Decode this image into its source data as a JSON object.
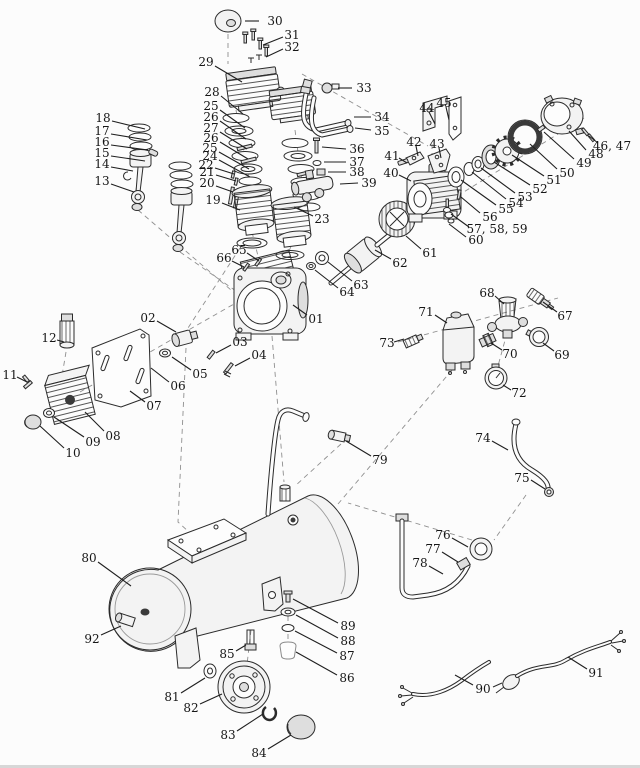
{
  "meta": {
    "description": "Exploded parts diagram of a portable air compressor, black line art on white",
    "bg": "#fcfcfc",
    "ink": "#2b2b2b",
    "label_color": "#161616",
    "dash_color": "#8f8f8f",
    "edge_strip": "#d7d7d7"
  },
  "diagram": {
    "parts": [
      {
        "n": "30",
        "x": 275,
        "y": 21,
        "l": [
          259,
          21,
          245,
          21
        ]
      },
      {
        "n": "31",
        "x": 292,
        "y": 35,
        "l": [
          283,
          37,
          263,
          45
        ]
      },
      {
        "n": "32",
        "x": 292,
        "y": 47,
        "l": [
          283,
          49,
          266,
          57
        ]
      },
      {
        "n": "29",
        "x": 206,
        "y": 62,
        "l": [
          215,
          66,
          242,
          82
        ]
      },
      {
        "n": "33",
        "x": 364,
        "y": 88,
        "l": [
          352,
          88,
          338,
          88
        ]
      },
      {
        "n": "34",
        "x": 382,
        "y": 117,
        "l": [
          371,
          117,
          354,
          117
        ]
      },
      {
        "n": "35",
        "x": 382,
        "y": 131,
        "l": [
          371,
          130,
          355,
          128
        ]
      },
      {
        "n": "18",
        "x": 103,
        "y": 118,
        "l": [
          112,
          121,
          145,
          129
        ]
      },
      {
        "n": "17",
        "x": 102,
        "y": 131,
        "l": [
          111,
          134,
          147,
          140
        ]
      },
      {
        "n": "16",
        "x": 102,
        "y": 142,
        "l": [
          111,
          145,
          148,
          150
        ]
      },
      {
        "n": "15",
        "x": 102,
        "y": 153,
        "l": [
          111,
          156,
          145,
          161
        ]
      },
      {
        "n": "14",
        "x": 102,
        "y": 164,
        "l": [
          111,
          167,
          133,
          171
        ]
      },
      {
        "n": "13",
        "x": 102,
        "y": 181,
        "l": [
          111,
          184,
          134,
          192
        ]
      },
      {
        "n": "28",
        "x": 212,
        "y": 92,
        "l": [
          221,
          96,
          243,
          114
        ]
      },
      {
        "n": "25",
        "x": 211,
        "y": 106,
        "l": [
          220,
          110,
          245,
          128
        ]
      },
      {
        "n": "26",
        "x": 211,
        "y": 117,
        "l": [
          220,
          121,
          246,
          139
        ]
      },
      {
        "n": "27",
        "x": 211,
        "y": 128,
        "l": [
          220,
          132,
          247,
          149
        ]
      },
      {
        "n": "26",
        "x": 211,
        "y": 138,
        "l": [
          220,
          142,
          248,
          159
        ]
      },
      {
        "n": "25",
        "x": 210,
        "y": 148,
        "l": [
          219,
          152,
          249,
          169
        ]
      },
      {
        "n": "24",
        "x": 210,
        "y": 156,
        "l": [
          219,
          160,
          250,
          177
        ]
      },
      {
        "n": "22",
        "x": 206,
        "y": 165,
        "l": [
          215,
          168,
          234,
          174
        ]
      },
      {
        "n": "21",
        "x": 207,
        "y": 172,
        "l": [
          216,
          175,
          236,
          181
        ]
      },
      {
        "n": "20",
        "x": 207,
        "y": 183,
        "l": [
          216,
          186,
          233,
          192
        ]
      },
      {
        "n": "19",
        "x": 213,
        "y": 200,
        "l": [
          222,
          203,
          240,
          210
        ]
      },
      {
        "n": "23",
        "x": 322,
        "y": 219,
        "l": [
          313,
          216,
          294,
          207
        ]
      },
      {
        "n": "44",
        "x": 427,
        "y": 108,
        "l": [
          429,
          112,
          435,
          124
        ]
      },
      {
        "n": "45",
        "x": 444,
        "y": 103,
        "l": [
          446,
          107,
          449,
          120
        ]
      },
      {
        "n": "42",
        "x": 414,
        "y": 142,
        "l": [
          416,
          146,
          418,
          156
        ]
      },
      {
        "n": "43",
        "x": 437,
        "y": 144,
        "l": [
          439,
          148,
          441,
          158
        ]
      },
      {
        "n": "41",
        "x": 392,
        "y": 156,
        "l": [
          399,
          158,
          407,
          163
        ]
      },
      {
        "n": "40",
        "x": 391,
        "y": 173,
        "l": [
          399,
          175,
          411,
          181
        ]
      },
      {
        "n": "46, 47",
        "x": 612,
        "y": 146,
        "l": [
          598,
          143,
          589,
          136
        ]
      },
      {
        "n": "48",
        "x": 596,
        "y": 154,
        "l": [
          586,
          150,
          569,
          131
        ]
      },
      {
        "n": "49",
        "x": 584,
        "y": 163,
        "l": [
          574,
          159,
          544,
          132
        ]
      },
      {
        "n": "50",
        "x": 567,
        "y": 173,
        "l": [
          557,
          169,
          530,
          144
        ]
      },
      {
        "n": "51",
        "x": 554,
        "y": 180,
        "l": [
          544,
          176,
          512,
          155
        ]
      },
      {
        "n": "52",
        "x": 540,
        "y": 189,
        "l": [
          530,
          185,
          494,
          162
        ]
      },
      {
        "n": "53",
        "x": 525,
        "y": 197,
        "l": [
          515,
          193,
          481,
          168
        ]
      },
      {
        "n": "54",
        "x": 516,
        "y": 203,
        "l": [
          506,
          199,
          472,
          172
        ]
      },
      {
        "n": "55",
        "x": 506,
        "y": 209,
        "l": [
          496,
          205,
          461,
          180
        ]
      },
      {
        "n": "56",
        "x": 490,
        "y": 217,
        "l": [
          480,
          213,
          461,
          197
        ]
      },
      {
        "n": "57, 58, 59",
        "x": 497,
        "y": 229,
        "l": [
          469,
          227,
          451,
          214
        ]
      },
      {
        "n": "60",
        "x": 476,
        "y": 240,
        "l": [
          466,
          237,
          449,
          224
        ]
      },
      {
        "n": "36",
        "x": 357,
        "y": 149,
        "l": [
          346,
          149,
          322,
          147
        ]
      },
      {
        "n": "37",
        "x": 357,
        "y": 162,
        "l": [
          346,
          162,
          324,
          162
        ]
      },
      {
        "n": "38",
        "x": 357,
        "y": 172,
        "l": [
          346,
          172,
          328,
          172
        ]
      },
      {
        "n": "39",
        "x": 369,
        "y": 183,
        "l": [
          358,
          183,
          340,
          184
        ]
      },
      {
        "n": "65",
        "x": 239,
        "y": 250,
        "l": [
          247,
          253,
          259,
          261
        ]
      },
      {
        "n": "66",
        "x": 224,
        "y": 258,
        "l": [
          232,
          261,
          244,
          267
        ]
      },
      {
        "n": "63",
        "x": 361,
        "y": 285,
        "l": [
          352,
          281,
          328,
          262
        ]
      },
      {
        "n": "64",
        "x": 347,
        "y": 292,
        "l": [
          338,
          288,
          315,
          270
        ]
      },
      {
        "n": "01",
        "x": 316,
        "y": 319,
        "l": [
          307,
          315,
          293,
          305
        ]
      },
      {
        "n": "02",
        "x": 148,
        "y": 318,
        "l": [
          157,
          321,
          176,
          332
        ]
      },
      {
        "n": "03",
        "x": 240,
        "y": 342,
        "l": [
          231,
          345,
          216,
          353
        ]
      },
      {
        "n": "04",
        "x": 259,
        "y": 355,
        "l": [
          250,
          358,
          235,
          366
        ]
      },
      {
        "n": "05",
        "x": 200,
        "y": 374,
        "l": [
          191,
          370,
          172,
          357
        ]
      },
      {
        "n": "06",
        "x": 178,
        "y": 386,
        "l": [
          169,
          382,
          151,
          368
        ]
      },
      {
        "n": "07",
        "x": 154,
        "y": 406,
        "l": [
          145,
          402,
          130,
          391
        ]
      },
      {
        "n": "08",
        "x": 113,
        "y": 436,
        "l": [
          104,
          431,
          85,
          412
        ]
      },
      {
        "n": "09",
        "x": 93,
        "y": 442,
        "l": [
          84,
          437,
          54,
          417
        ]
      },
      {
        "n": "10",
        "x": 73,
        "y": 453,
        "l": [
          64,
          448,
          40,
          426
        ]
      },
      {
        "n": "11",
        "x": 10,
        "y": 375,
        "l": [
          17,
          377,
          27,
          382
        ]
      },
      {
        "n": "12",
        "x": 49,
        "y": 338,
        "l": [
          57,
          340,
          64,
          342
        ]
      },
      {
        "n": "68",
        "x": 487,
        "y": 293,
        "l": [
          495,
          296,
          504,
          304
        ]
      },
      {
        "n": "67",
        "x": 565,
        "y": 316,
        "l": [
          557,
          312,
          543,
          302
        ]
      },
      {
        "n": "71",
        "x": 426,
        "y": 312,
        "l": [
          435,
          315,
          447,
          323
        ]
      },
      {
        "n": "73",
        "x": 387,
        "y": 343,
        "l": [
          394,
          342,
          404,
          339
        ]
      },
      {
        "n": "70",
        "x": 510,
        "y": 354,
        "l": [
          502,
          350,
          491,
          343
        ]
      },
      {
        "n": "69",
        "x": 562,
        "y": 355,
        "l": [
          554,
          351,
          543,
          343
        ]
      },
      {
        "n": "72",
        "x": 519,
        "y": 393,
        "l": [
          511,
          390,
          503,
          385
        ]
      },
      {
        "n": "79",
        "x": 380,
        "y": 460,
        "l": [
          371,
          456,
          346,
          441
        ]
      },
      {
        "n": "74",
        "x": 483,
        "y": 438,
        "l": [
          492,
          441,
          508,
          450
        ]
      },
      {
        "n": "75",
        "x": 522,
        "y": 478,
        "l": [
          531,
          480,
          545,
          489
        ]
      },
      {
        "n": "76",
        "x": 443,
        "y": 535,
        "l": [
          452,
          538,
          468,
          547
        ]
      },
      {
        "n": "77",
        "x": 433,
        "y": 549,
        "l": [
          442,
          552,
          458,
          562
        ]
      },
      {
        "n": "78",
        "x": 420,
        "y": 563,
        "l": [
          429,
          566,
          443,
          574
        ]
      },
      {
        "n": "80",
        "x": 89,
        "y": 558,
        "l": [
          98,
          562,
          131,
          586
        ]
      },
      {
        "n": "92",
        "x": 92,
        "y": 639,
        "l": [
          101,
          635,
          121,
          626
        ]
      },
      {
        "n": "85",
        "x": 227,
        "y": 654,
        "l": [
          236,
          651,
          246,
          645
        ]
      },
      {
        "n": "81",
        "x": 172,
        "y": 697,
        "l": [
          181,
          693,
          205,
          678
        ]
      },
      {
        "n": "82",
        "x": 191,
        "y": 708,
        "l": [
          200,
          704,
          222,
          694
        ]
      },
      {
        "n": "83",
        "x": 228,
        "y": 735,
        "l": [
          237,
          731,
          263,
          714
        ]
      },
      {
        "n": "84",
        "x": 259,
        "y": 753,
        "l": [
          268,
          749,
          291,
          735
        ]
      },
      {
        "n": "89",
        "x": 348,
        "y": 626,
        "l": [
          338,
          623,
          293,
          599
        ]
      },
      {
        "n": "88",
        "x": 348,
        "y": 641,
        "l": [
          338,
          638,
          296,
          615
        ]
      },
      {
        "n": "87",
        "x": 347,
        "y": 656,
        "l": [
          337,
          653,
          295,
          631
        ]
      },
      {
        "n": "86",
        "x": 347,
        "y": 678,
        "l": [
          337,
          675,
          296,
          652
        ]
      },
      {
        "n": "90",
        "x": 483,
        "y": 689,
        "l": [
          473,
          685,
          455,
          675
        ]
      },
      {
        "n": "91",
        "x": 596,
        "y": 673,
        "l": [
          587,
          669,
          568,
          657
        ]
      },
      {
        "n": "61",
        "x": 430,
        "y": 253,
        "l": [
          421,
          249,
          406,
          236
        ]
      },
      {
        "n": "62",
        "x": 400,
        "y": 263,
        "l": [
          391,
          259,
          375,
          250
        ]
      }
    ]
  }
}
